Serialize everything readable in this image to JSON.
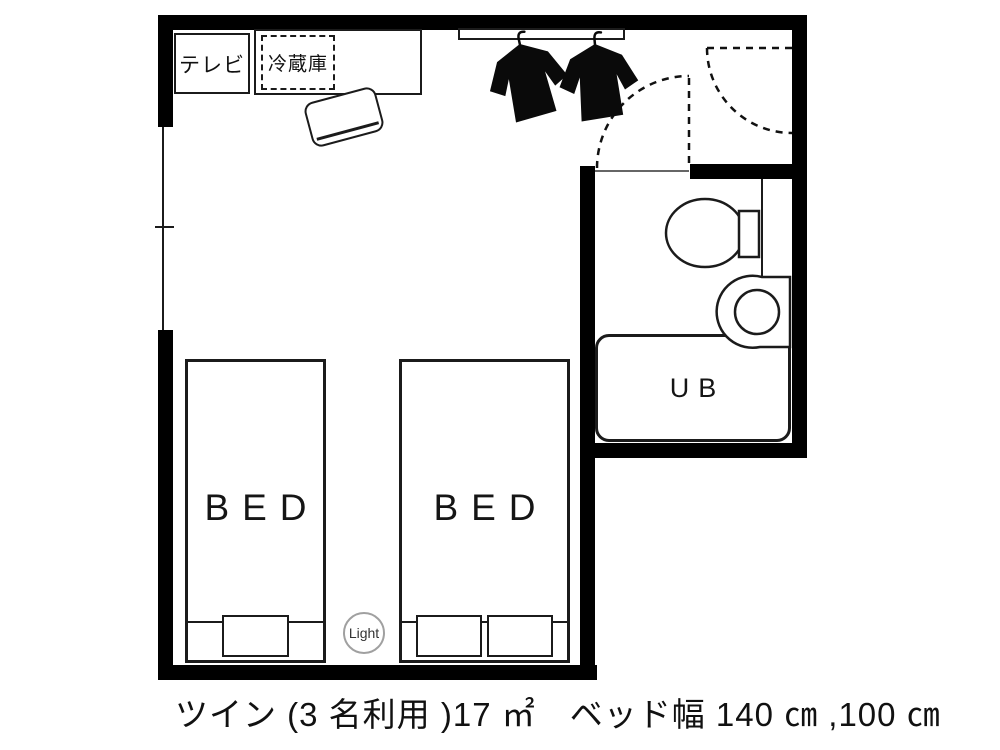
{
  "floorplan": {
    "caption": "ツイン (3 名利用 )17 ㎡　ベッド幅 140 ㎝ ,100 ㎝",
    "labels": {
      "tv": "テレビ",
      "fridge": "冷蔵庫",
      "bed_left": "BED",
      "bed_right": "BED",
      "unit_bath": "UB",
      "light": "Light"
    },
    "icons": {
      "garments": "hanging-jacket-icon",
      "toilet": "toilet-icon",
      "sink": "round-sink-icon",
      "entry_door": "door-swing-arc-icon",
      "bathroom_door": "door-swing-arc-icon",
      "window": "window-mullion-tick"
    },
    "colors": {
      "wall": "#000000",
      "line": "#1b1b1b",
      "background": "#ffffff",
      "light_circle_border": "#a0a0a0"
    }
  }
}
